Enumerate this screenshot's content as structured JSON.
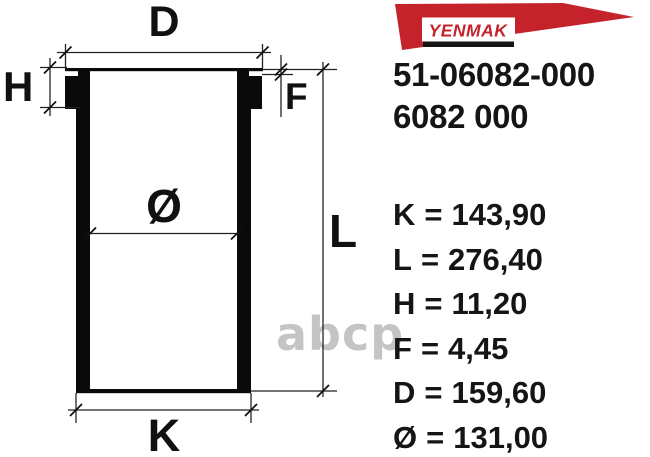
{
  "brand": {
    "logo_text": "YENMAK",
    "logo_red": "#c4232b",
    "logo_bar_color": "#141414"
  },
  "part_numbers": {
    "primary": "51-06082-000",
    "secondary": "6082 000"
  },
  "diagram": {
    "labels": {
      "flange_diameter": "D",
      "flange_height": "H",
      "collar_step": "F",
      "total_length": "L",
      "bore_diameter": "Ø",
      "body_diameter": "K"
    }
  },
  "specs": {
    "separator": "=",
    "items": [
      {
        "name": "K",
        "value": "143,90",
        "display": "K = 143,90"
      },
      {
        "name": "L",
        "value": "276,40",
        "display": "L = 276,40"
      },
      {
        "name": "H",
        "value": "11,20",
        "display": "H = 11,20"
      },
      {
        "name": "F",
        "value": "4,45",
        "display": "F = 4,45"
      },
      {
        "name": "D",
        "value": "159,60",
        "display": "D = 159,60"
      },
      {
        "name": "Ø",
        "value": "131,00",
        "display": "Ø = 131,00"
      }
    ]
  },
  "watermark": {
    "text": "abcp",
    "color": "#c4c4c4"
  }
}
